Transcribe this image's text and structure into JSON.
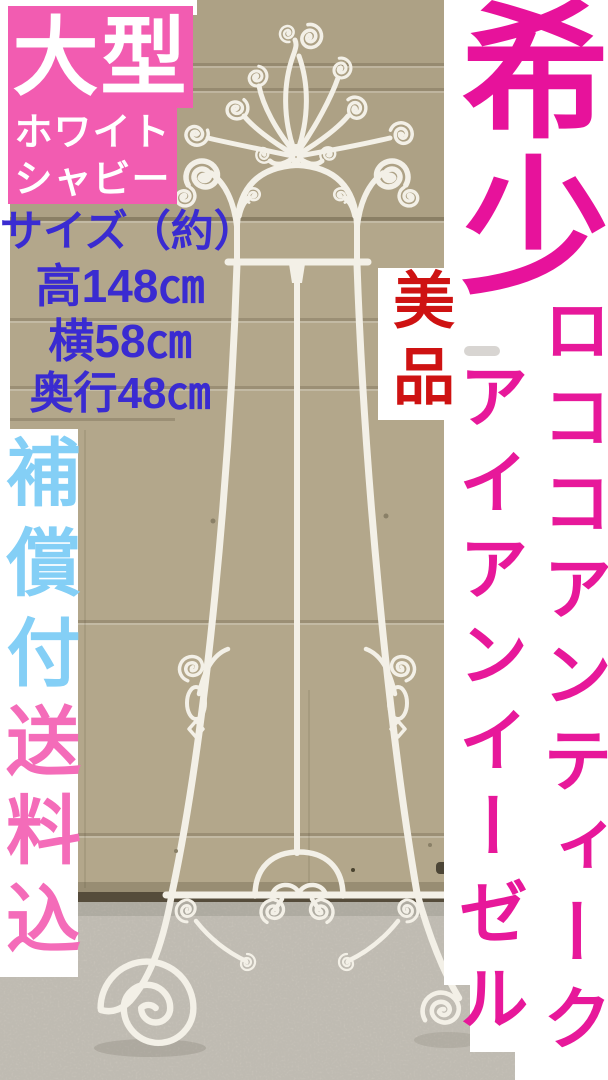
{
  "overlays": {
    "top_left_box": {
      "title": "大型",
      "line2": "ホワイト",
      "line3": "シャビー"
    },
    "size_block": {
      "heading": "サイズ（約）",
      "height": "高148㎝",
      "width": "横58㎝",
      "depth": "奥行48㎝"
    },
    "condition_badge": "美品",
    "rare_badge": "希少",
    "right_vertical_outer": "ロココアンティーク",
    "right_vertical_inner": "アイアンイーゼル",
    "left_vertical_top": "補償付",
    "left_vertical_bottom": "送料込"
  },
  "colors": {
    "box_pink": "#f25cb1",
    "magenta_text": "#e7149a",
    "light_blue_text": "#84cff6",
    "deep_blue_text": "#3a2bd1",
    "red_text": "#ce1212",
    "door_beige": "#b3a78b",
    "carpet_gray": "#cfcabf",
    "easel_white": "#f3f0e7"
  }
}
